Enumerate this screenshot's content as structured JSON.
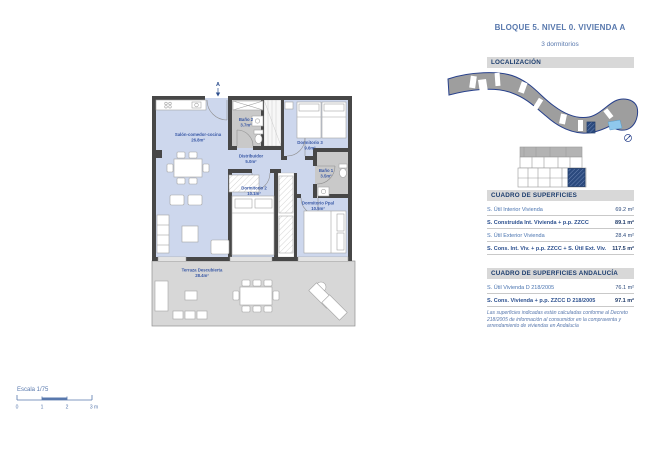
{
  "header": {
    "title": "BLOQUE 5. NIVEL 0. VIVIENDA A",
    "subtitle": "3 dormitorios"
  },
  "localizacion": {
    "heading": "LOCALIZACIÓN"
  },
  "floorplan": {
    "section_marker": "A",
    "rooms": [
      {
        "name": "Salón-comedor-cocina",
        "area": "26.8m²"
      },
      {
        "name": "Baño 2",
        "area": "3.7m²"
      },
      {
        "name": "Dormitorio 3",
        "area": "9.6m²"
      },
      {
        "name": "Distribuidor",
        "area": "5.0m²"
      },
      {
        "name": "Baño 1",
        "area": "3.5m²"
      },
      {
        "name": "Dormitorio 2",
        "area": "10.1m²"
      },
      {
        "name": "Dormitorio Ppal",
        "area": "10.5m²"
      },
      {
        "name": "Terraza Descubierta",
        "area": "28.4m²"
      }
    ],
    "scale": {
      "label": "Escala 1/75",
      "ticks": [
        "0",
        "1",
        "2",
        "3 m"
      ]
    }
  },
  "tables": [
    {
      "heading": "CUADRO DE SUPERFICIES",
      "rows": [
        {
          "label": "S. Útil Interior Vivienda",
          "value": "69.2 m²"
        },
        {
          "label": "S. Construida Int. Vivienda + p.p. ZZCC",
          "value": "89.1 m²"
        },
        {
          "label": "S. Útil Exterior Vivienda",
          "value": "28.4 m²"
        },
        {
          "label": "S. Cons. Int. Viv. + p.p. ZZCC + S. Útil Ext. Viv.",
          "value": "117.5 m²"
        }
      ]
    },
    {
      "heading": "CUADRO DE SUPERFICIES ANDALUCÍA",
      "rows": [
        {
          "label": "S. Útil Vivienda D 218/2005",
          "value": "76.1 m²"
        },
        {
          "label": "S. Cons. Vivienda + p.p. ZZCC D 218/2005",
          "value": "97.1 m²"
        }
      ]
    }
  ],
  "footnote": "Las superficies indicadas están calculadas conforme al Decreto 218/2005 de información al consumidor en la compraventa y arrendamiento de viviendas en Andalucía",
  "colors": {
    "accent_navy": "#1f3a68",
    "text_blue": "#4a74b0",
    "header_blue": "#5878ad",
    "bar_bg": "#d8d8d8",
    "room_fill": "#cdd7ed",
    "bath_fill": "#c9c9c9",
    "wall": "#474747",
    "terrace_fill": "#d7d7d7",
    "site_fill": "#9e9e9e",
    "highlight_navy": "#2b4a7e",
    "pool_blue": "#8fc8ec"
  }
}
